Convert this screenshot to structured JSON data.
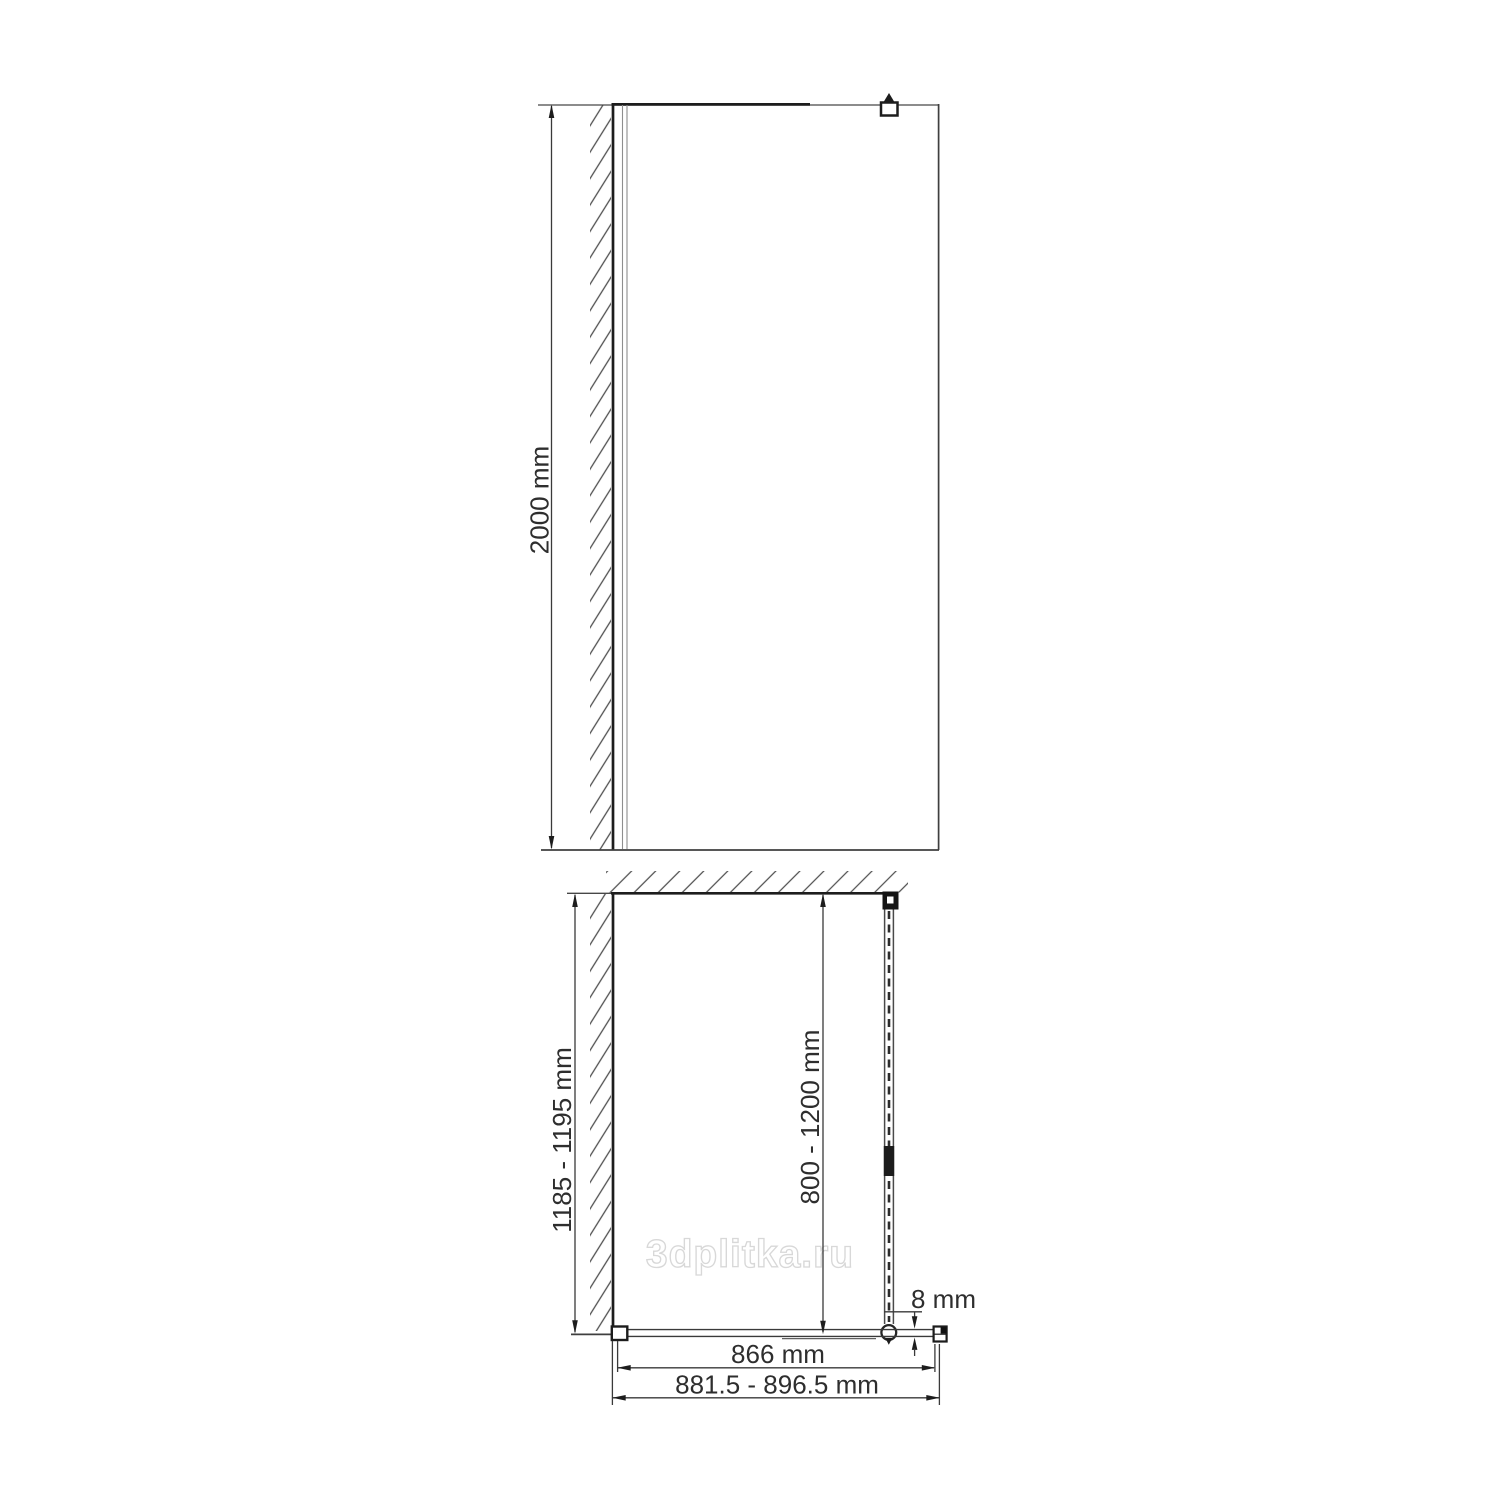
{
  "watermark": {
    "text": "3dplitka.ru"
  },
  "drawing": {
    "front_view": {
      "height_label": "2000 mm"
    },
    "plan_view": {
      "depth_label": "1185 - 1195 mm",
      "support_bar_label": "800 - 1200 mm",
      "glass_thickness_label": "8 mm",
      "glass_width_label": "866 mm",
      "overall_width_label": "881.5 - 896.5 mm"
    }
  },
  "colors": {
    "background": "#ffffff",
    "line": "#3f3f3f",
    "wall_line": "#1d1d1d",
    "hatch": "#4f4f4f",
    "profile_line": "#8e8e8e",
    "text": "#2e2e2e",
    "watermark": "#d8d8d8"
  }
}
